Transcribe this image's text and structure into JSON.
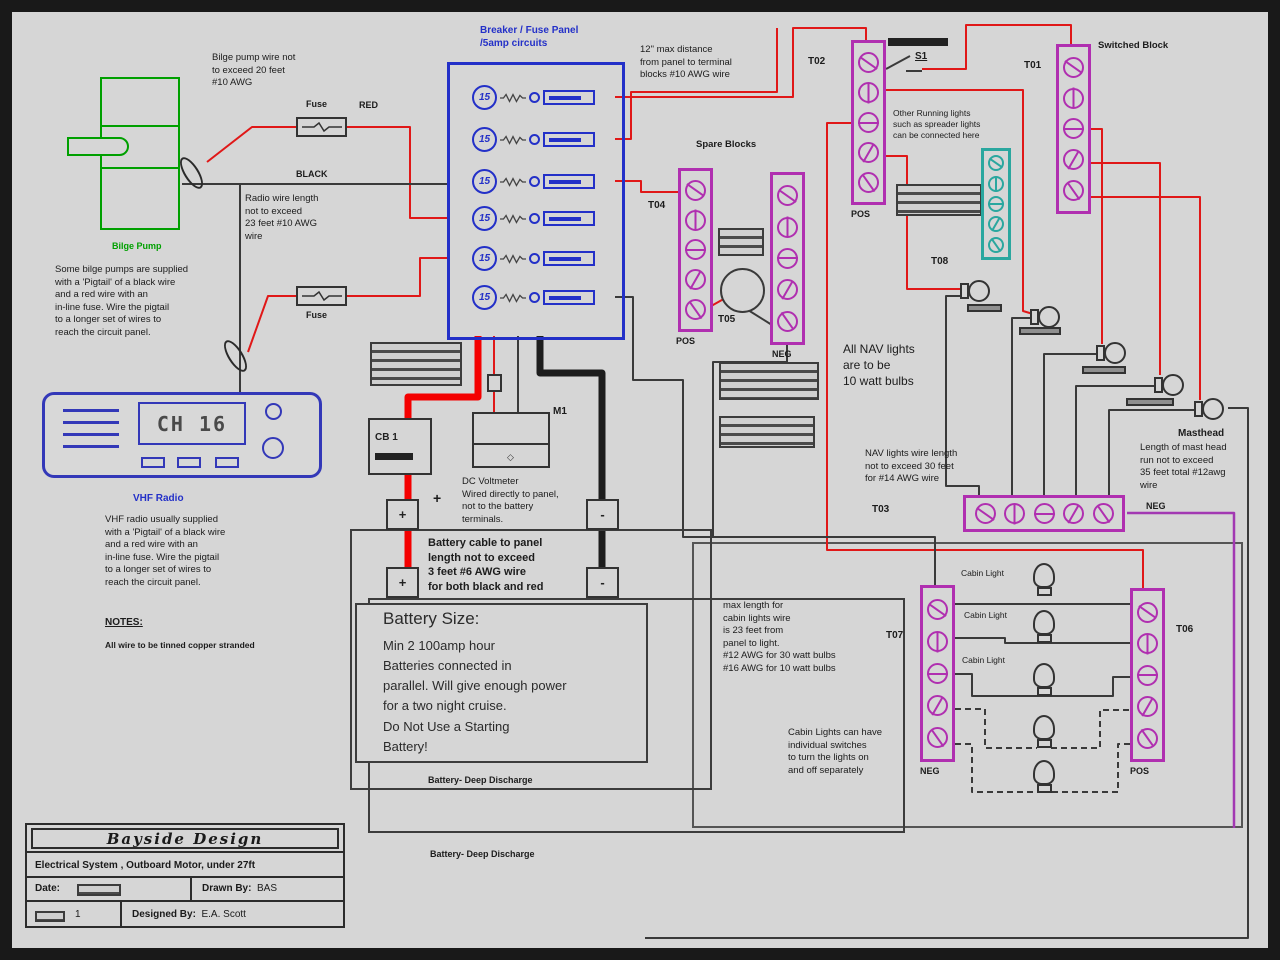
{
  "colors": {
    "wire_red": "#e01818",
    "wire_black": "#3a3a3a",
    "panel_blue": "#2330c8",
    "pump_green": "#00a000",
    "block_magenta": "#b02fb0",
    "block_teal": "#2aa79f",
    "wire_purple": "#a238b2"
  },
  "pump": {
    "label": "Bilge Pump"
  },
  "radio": {
    "label": "VHF Radio",
    "display": "CH 16"
  },
  "panel": {
    "title": "Breaker / Fuse Panel\n/5amp circuits",
    "amp": "15"
  },
  "notes": {
    "bilge_wire": "Bilge pump wire not\nto exceed 20 feet\n#10 AWG",
    "fuse_top": "Fuse",
    "red": "RED",
    "black": "BLACK",
    "radio_wire": "Radio wire length\nnot to exceed\n23 feet #10 AWG\nwire",
    "bilge_pigtail": "Some bilge pumps are supplied\nwith a 'Pigtail' of a black wire\nand a red wire with an\nin-line fuse. Wire the pigtail\nto a longer set of wires to\nreach the circuit panel.",
    "fuse_bottom": "Fuse",
    "vhf_pigtail": "VHF radio usually supplied\nwith a 'Pigtail' of a black wire\nand a red wire with an\nin-line fuse. Wire the pigtail\nto a longer set of wires to\nreach the circuit panel.",
    "notes_heading": "NOTES:",
    "notes_body": "All wire to be tinned copper stranded",
    "panel_distance": "12\" max distance\nfrom panel to terminal\nblocks #10 AWG wire",
    "running_lights": "Other Running lights\nsuch as spreader lights\ncan be connected here",
    "nav_bulbs": "All NAV lights\nare to be\n10 watt bulbs",
    "nav_wire": "NAV lights wire length\nnot to exceed 30 feet\nfor #14 AWG wire",
    "masthead_title": "Masthead",
    "masthead_body": "Length of mast head\nrun not to exceed\n35 feet total #12awg\nwire",
    "voltmeter": "DC Voltmeter\nWired directly to panel,\nnot to the battery\nterminals.",
    "battery_cable": "Battery cable to panel\nlength not to exceed\n3 feet #6 AWG wire\nfor both black and red",
    "cabin_wire": "max length for\ncabin lights wire\nis 23 feet from\npanel to light.\n#12 AWG for 30 watt bulbs\n#16 AWG for 10 watt bulbs",
    "cabin_switches": "Cabin Lights can have\nindividual switches\nto turn the lights on\nand off separately"
  },
  "blocks": {
    "t01": "T01",
    "t02": "T02",
    "t03": "T03",
    "t04": "T04",
    "t05": "T05",
    "t06": "T06",
    "t07": "T07",
    "t08": "T08",
    "pos": "POS",
    "neg": "NEG",
    "switched": "Switched Block",
    "spare": "Spare Blocks"
  },
  "devices": {
    "cb1": "CB 1",
    "m1": "M1",
    "s1": "S1",
    "plus": "+",
    "minus": "-"
  },
  "battery": {
    "size_title": "Battery Size:",
    "size_body": "Min 2  100amp hour\nBatteries connected in\nparallel. Will give enough power\nfor a two night cruise.\nDo Not Use a Starting\nBattery!",
    "type_label": "Battery- Deep Discharge"
  },
  "cabin": {
    "light_labels": [
      "Cabin Light",
      "Cabin Light",
      "Cabin Light"
    ]
  },
  "title_block": {
    "company": "Bayside Design",
    "subtitle": "Electrical System , Outboard Motor, under 27ft",
    "date_label": "Date:",
    "drawn_label": "Drawn By:",
    "drawn_by": "BAS",
    "sheet": "1",
    "designed_label": "Designed By:",
    "designed_by": "E.A. Scott"
  }
}
